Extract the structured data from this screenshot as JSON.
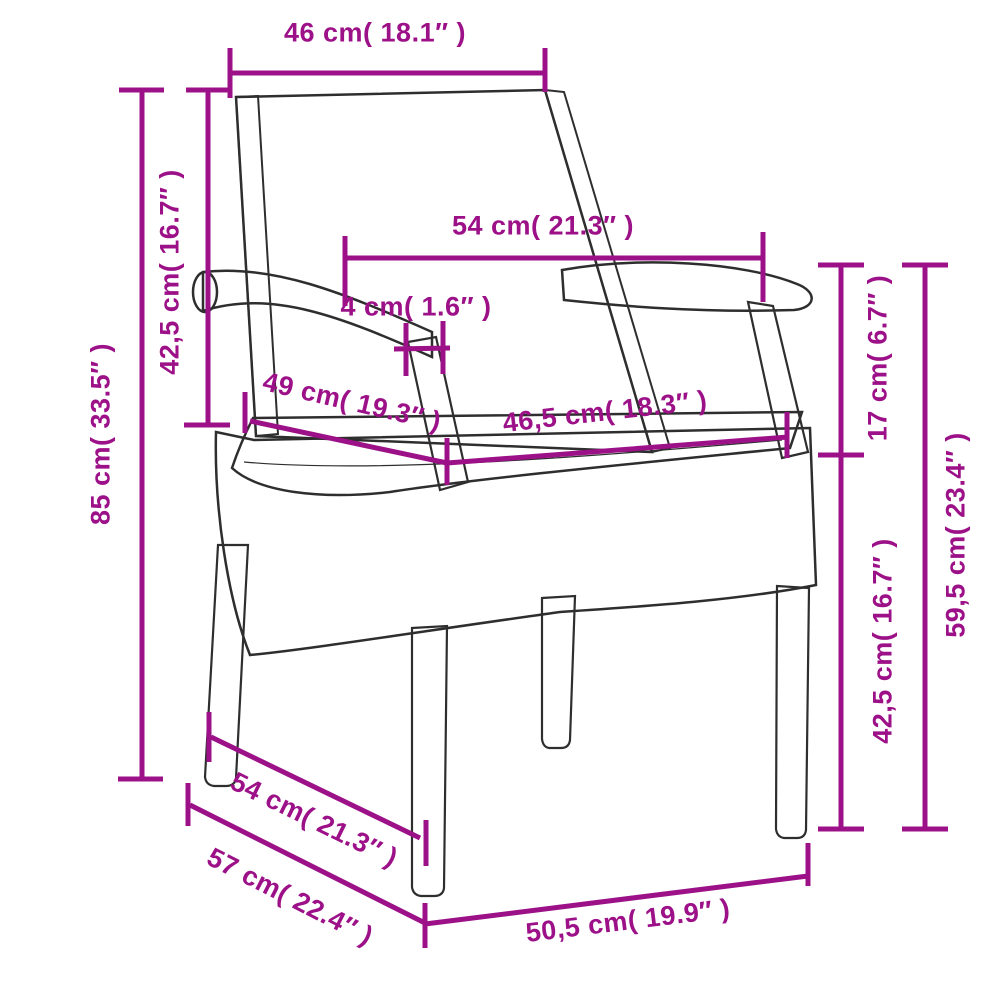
{
  "diagram": {
    "type": "product-dimension-diagram",
    "colors": {
      "dimension_accent": "#9C1088",
      "chair_outline": "#2e2e2e",
      "cushion_fill": "#f1f1f1",
      "background": "#ffffff"
    },
    "dimensions": {
      "back_width": {
        "label": "46 cm( 18.1″ )",
        "value_cm": 46,
        "value_in": 18.1
      },
      "back_inner_width": {
        "label": "54 cm( 21.3″ )",
        "value_cm": 54,
        "value_in": 21.3
      },
      "armrest_thickness": {
        "label": "4 cm( 1.6″ )",
        "value_cm": 4,
        "value_in": 1.6
      },
      "seat_depth": {
        "label": "49 cm( 19.3″ )",
        "value_cm": 49,
        "value_in": 19.3
      },
      "seat_width": {
        "label": "46,5 cm( 18.3″ )",
        "value_cm": 46.5,
        "value_in": 18.3
      },
      "backrest_height": {
        "label": "42,5 cm( 16.7″ )",
        "value_cm": 42.5,
        "value_in": 16.7
      },
      "total_height": {
        "label": "85 cm( 33.5″ )",
        "value_cm": 85,
        "value_in": 33.5
      },
      "armrest_to_seat": {
        "label": "17 cm( 6.7″ )",
        "value_cm": 17,
        "value_in": 6.7
      },
      "armrest_height": {
        "label": "59,5 cm( 23.4″ )",
        "value_cm": 59.5,
        "value_in": 23.4
      },
      "seat_height": {
        "label": "42,5 cm( 16.7″ )",
        "value_cm": 42.5,
        "value_in": 16.7
      },
      "depth_top": {
        "label": "54 cm( 21.3″ )",
        "value_cm": 54,
        "value_in": 21.3
      },
      "depth_total": {
        "label": "57 cm( 22.4″ )",
        "value_cm": 57,
        "value_in": 22.4
      },
      "base_width": {
        "label": "50,5 cm( 19.9″ )",
        "value_cm": 50.5,
        "value_in": 19.9
      }
    }
  }
}
